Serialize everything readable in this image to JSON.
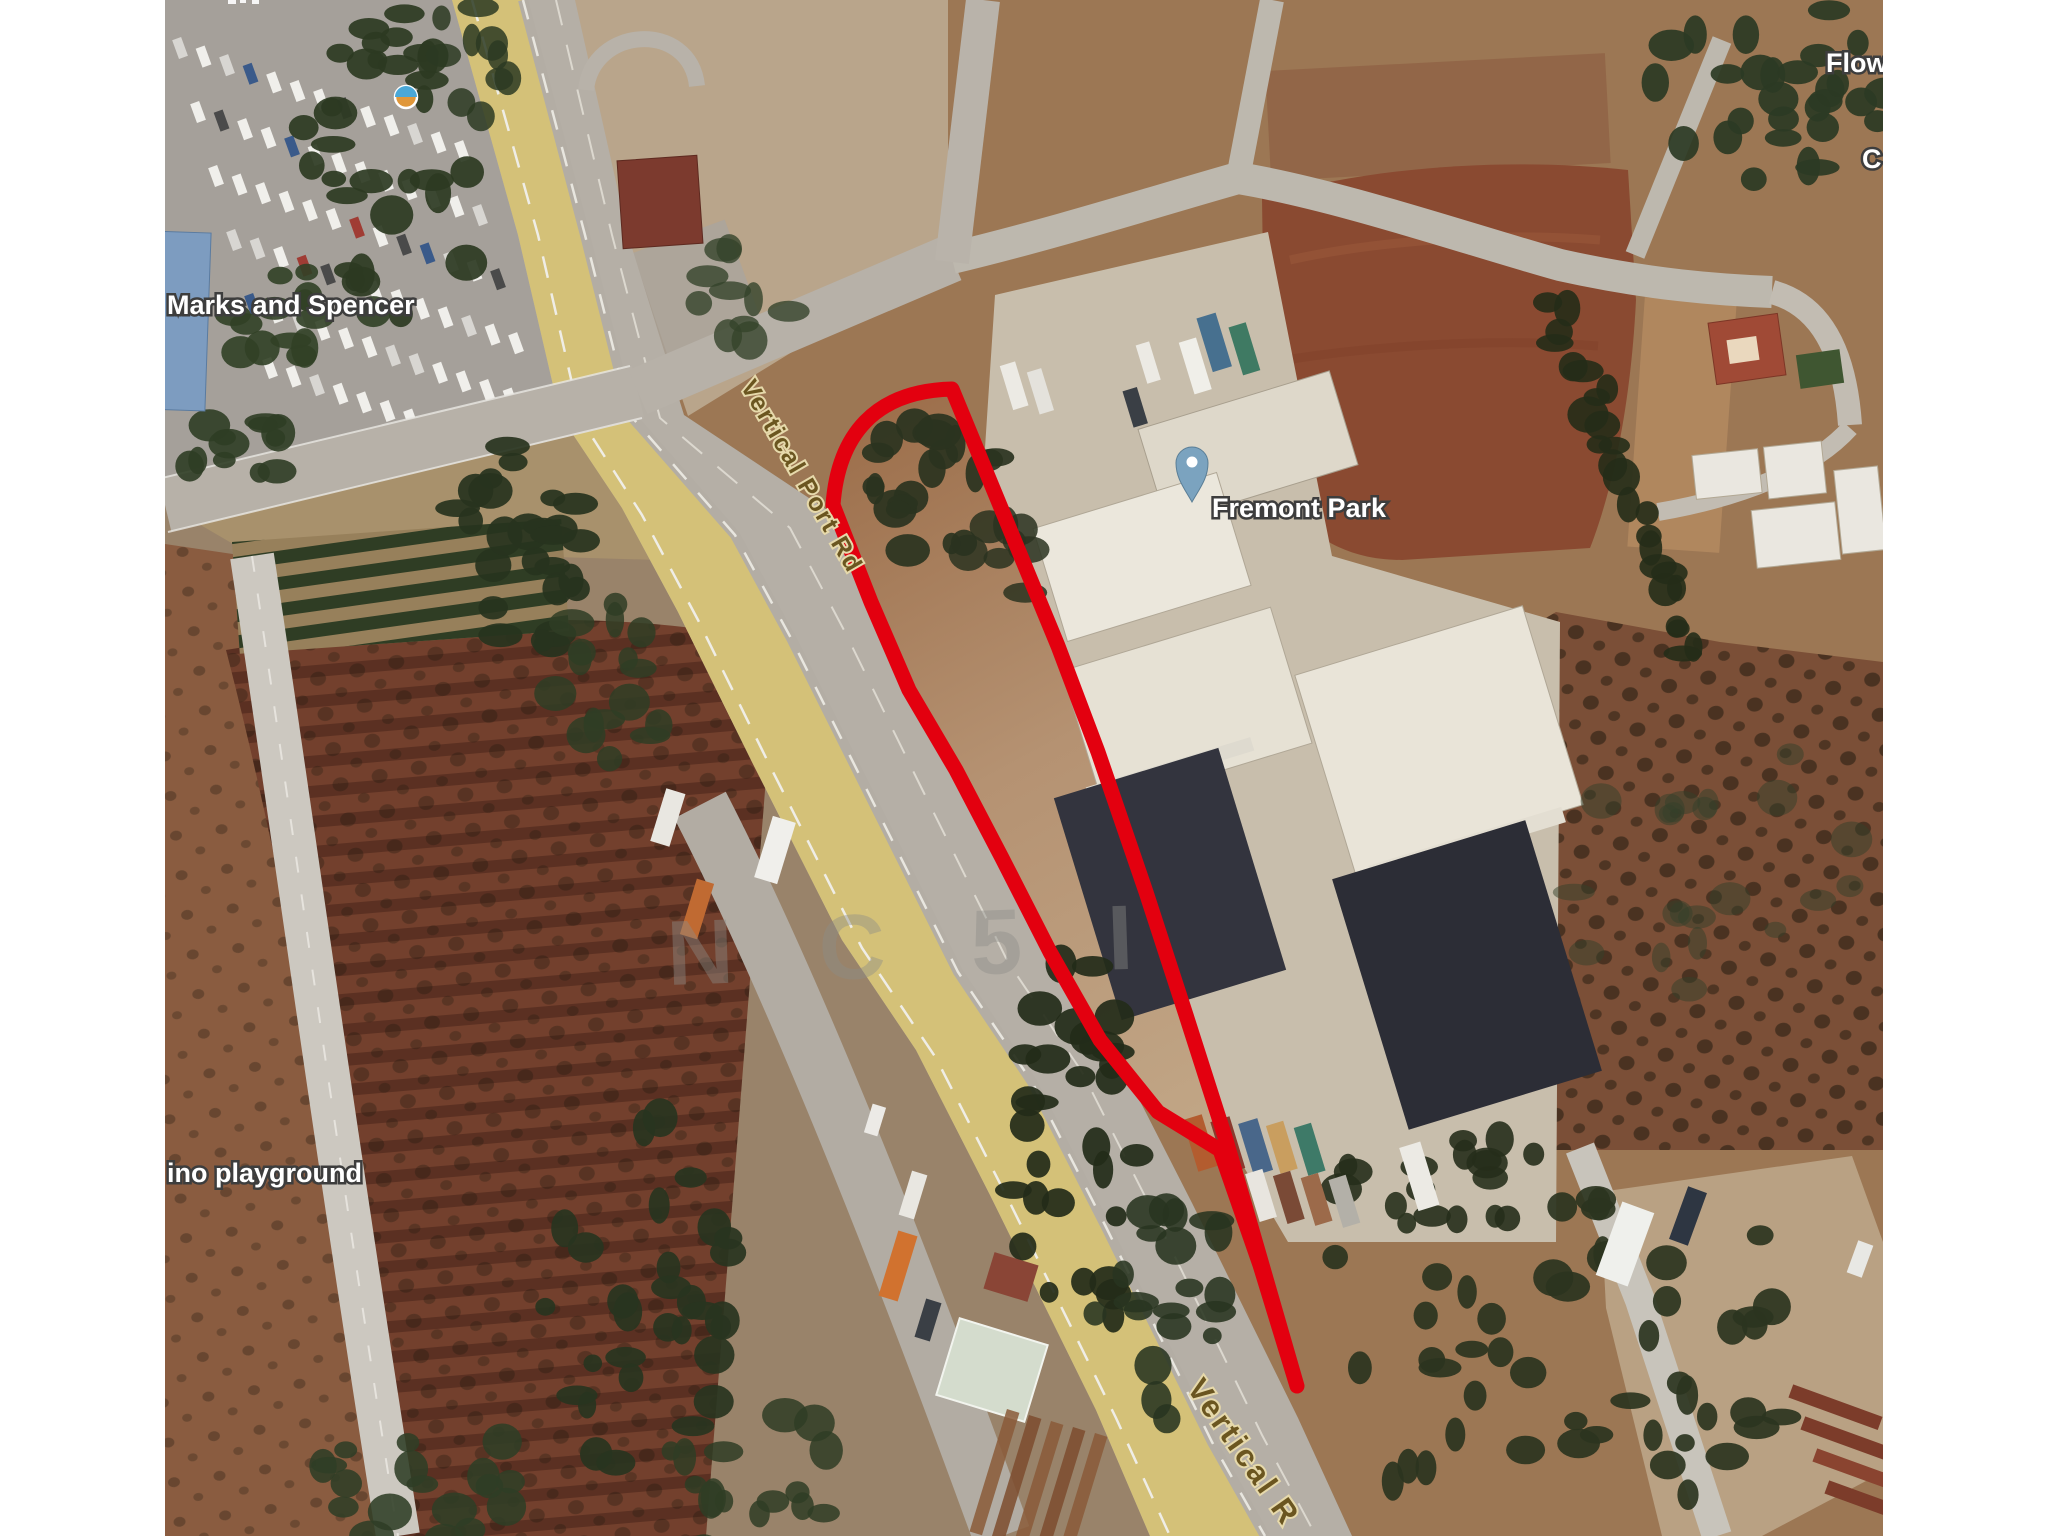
{
  "map_labels": {
    "marks": "Marks and Spencer",
    "fremont_park": "Fremont Park",
    "playground": "ino playground",
    "flower_partial": "Flow",
    "c_partial": "C"
  },
  "road_labels": {
    "top": "Vertical Port Rd",
    "bottom": "Vertical R"
  },
  "watermark": "N C 5 I",
  "icons": {
    "place_pin": "map-pin",
    "poi_dot": "poi-icon"
  },
  "colors": {
    "plot_outline": "#e3000f",
    "pin": "#7ba3bf",
    "highway_yellow": "#d4c178",
    "road_gray": "#b7b1a8"
  }
}
